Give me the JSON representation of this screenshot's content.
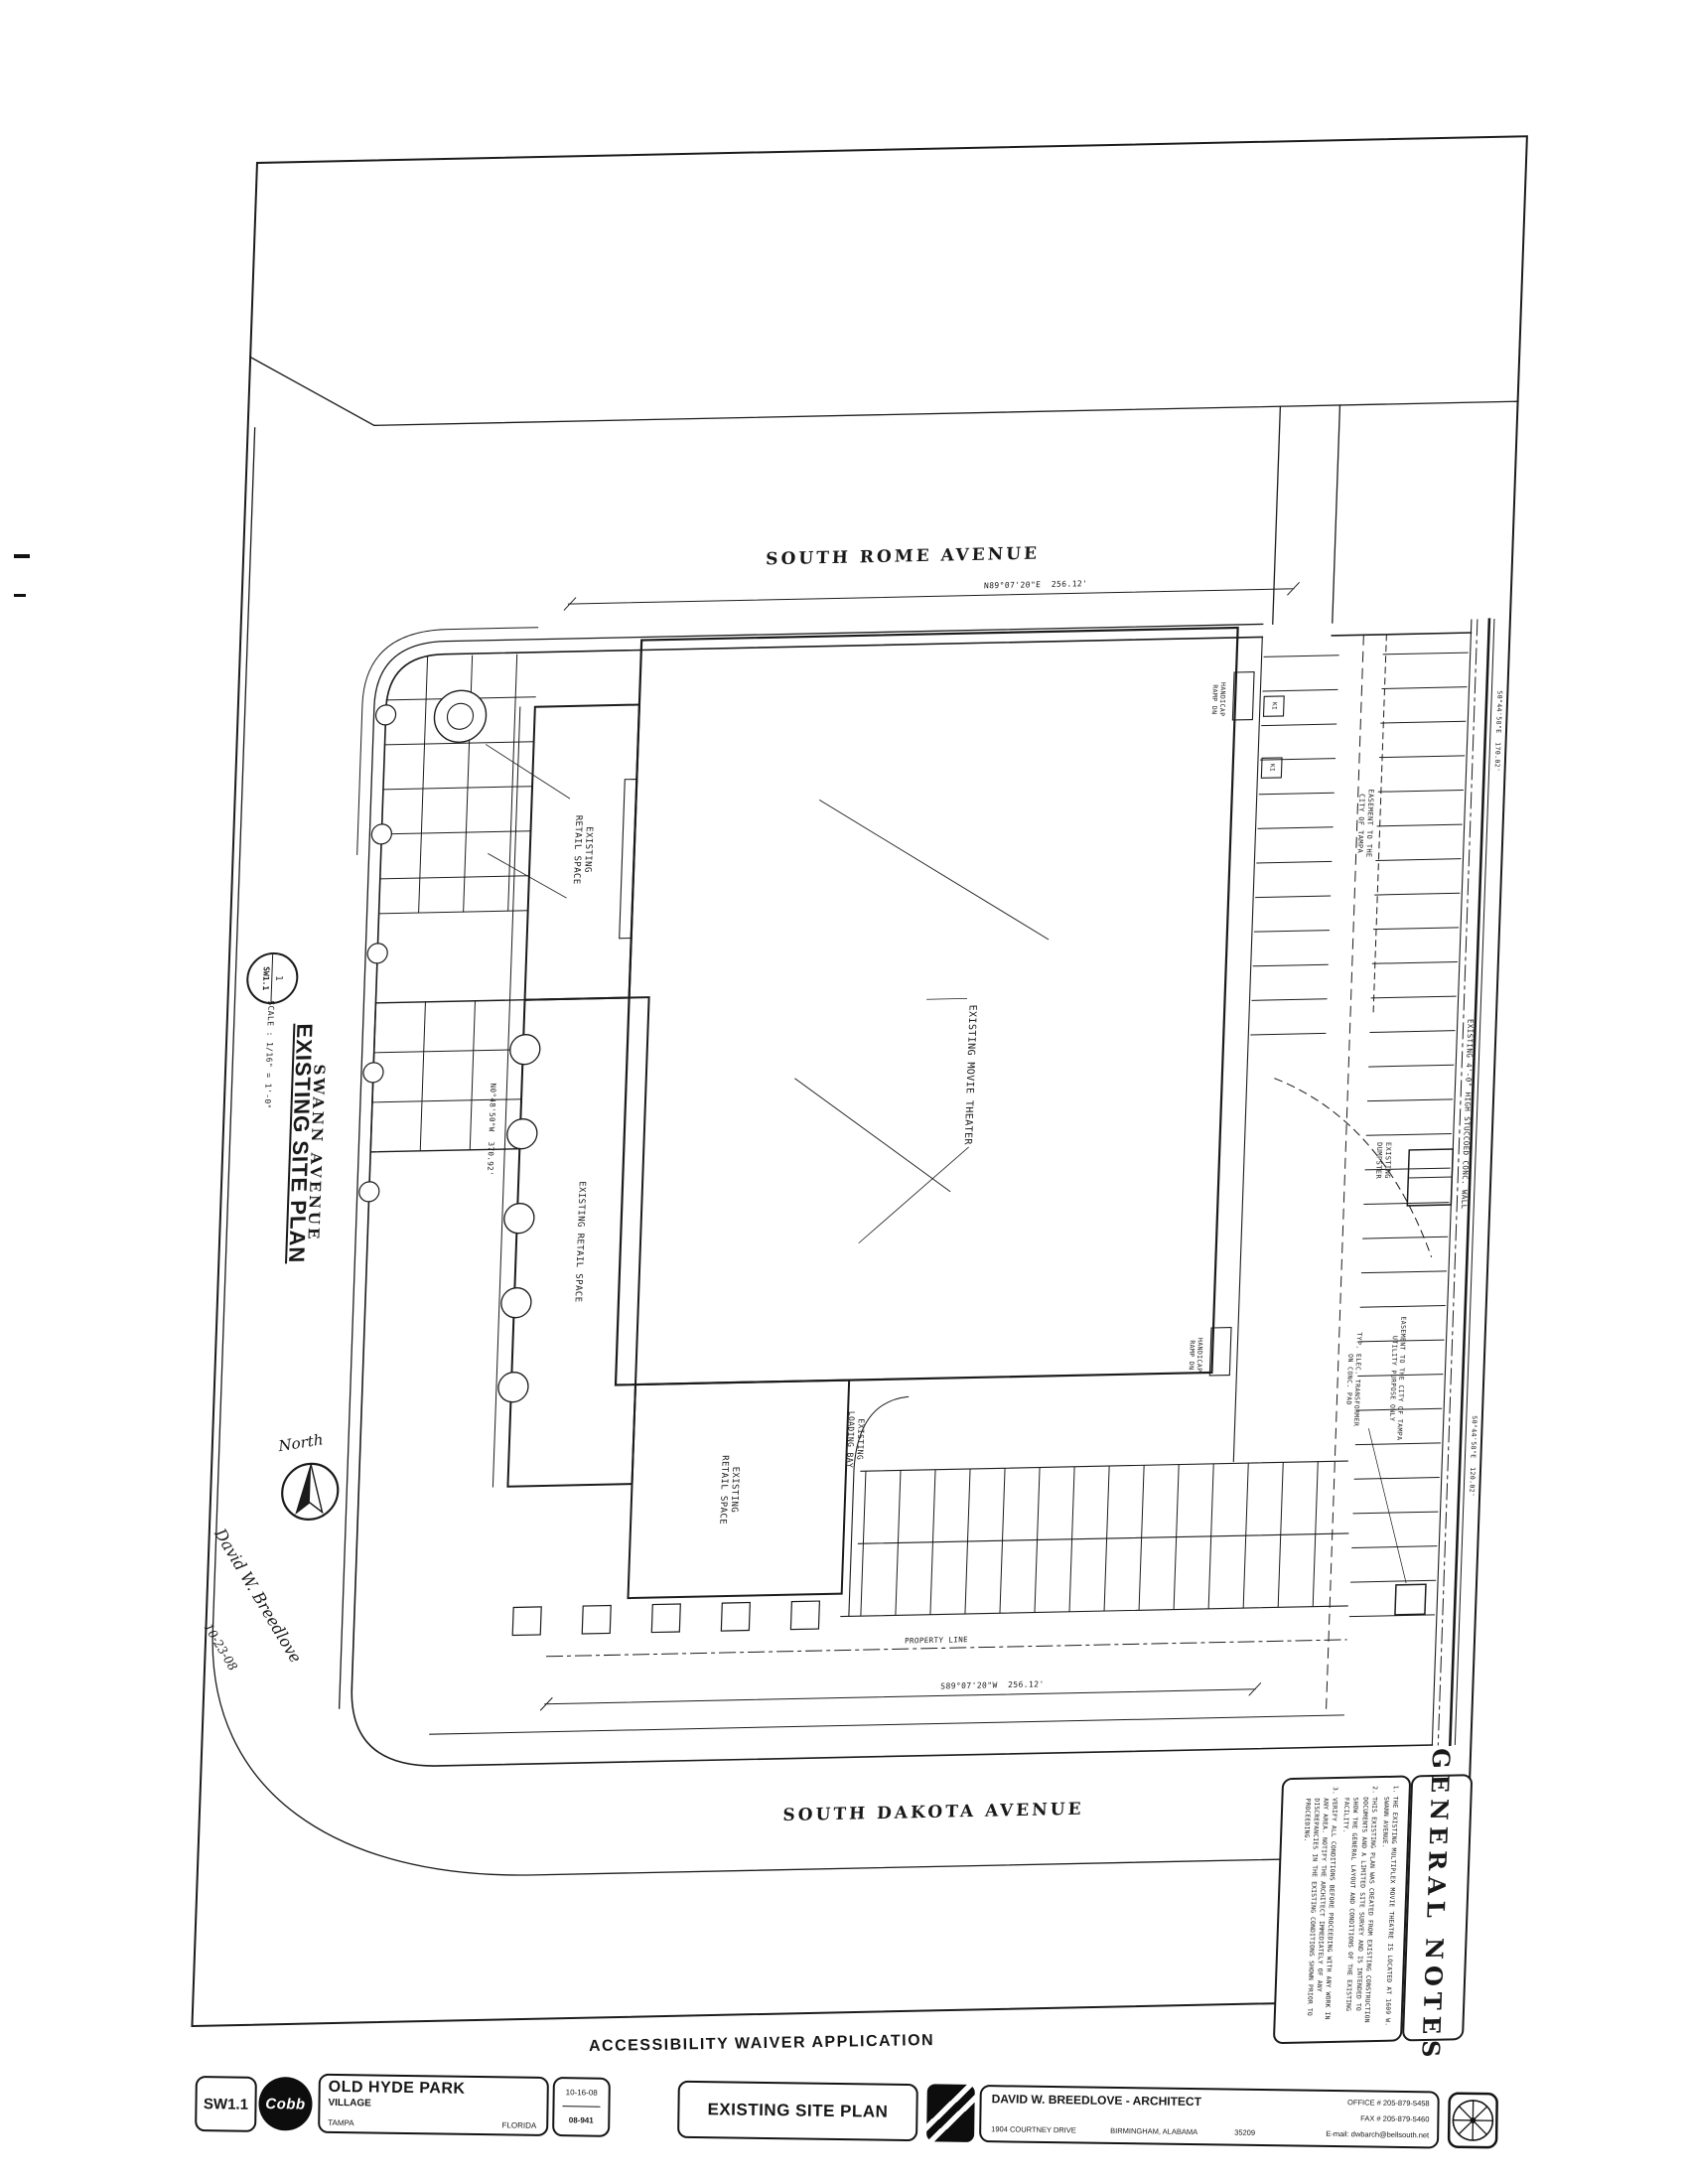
{
  "streets": {
    "north": "SOUTH ROME AVENUE",
    "south": "SOUTH DAKOTA AVENUE",
    "west": "SWANN AVENUE"
  },
  "callout": {
    "detail_number": "1",
    "sheet_ref": "SW1.1",
    "title": "EXISTING SITE PLAN",
    "scale": "SCALE : 1/16\" = 1'-0\""
  },
  "plan_labels": {
    "theater": "EXISTING MOVIE THEATER",
    "retail_upper": "EXISTING\nRETAIL SPACE",
    "retail_mid": "EXISTING RETAIL SPACE",
    "retail_south": "EXISTING\nRETAIL SPACE",
    "loading_bay": "EXISTING\nLOADING BAY",
    "handicap_ramp": "HANDICAP\nRAMP DN",
    "easement_top": "EASEMENT TO THE\nCITY OF TAMPA",
    "easement_utility": "EASEMENT TO THE CITY OF TAMPA\nUTILITY PURPOSE ONLY",
    "dumpster": "EXISTING\nDUMPSTER",
    "transformer": "TYP. ELEC. TRANSFORMER\nON CONC. PAD",
    "conc_wall": "EXISTING 4'-0\" HIGH STUCCOED CONC. WALL",
    "property_line": "PROPERTY LINE",
    "kiosk": "KI"
  },
  "bearings": {
    "top": "N89°07'20\"E  256.12'",
    "bottom": "S89°07'20\"W  256.12'",
    "left": "N0°48'50\"W  370.92'",
    "right_top": "S0°44'58\"E  170.02'",
    "right_bottom": "S0°44'58\"E  120.02'"
  },
  "handwritten": {
    "north": "North",
    "signature": "David W. Breedlove",
    "date": "10-23-08"
  },
  "general_notes": {
    "title": "GENERAL NOTES",
    "notes": [
      {
        "num": "1.",
        "text": "THE EXISTING MULTIPLEX MOVIE THEATRE IS LOCATED AT 1609 W. SWANN AVENUE."
      },
      {
        "num": "2.",
        "text": "THIS EXISTING PLAN WAS CREATED FROM EXISTING CONSTRUCTION DOCUMENTS AND A LIMITED SITE SURVEY AND IS INTENDED TO SHOW THE GENERAL LAYOUT AND CONDITIONS OF THE EXISTING FACILITY."
      },
      {
        "num": "3.",
        "text": "VERIFY ALL CONDITIONS BEFORE PROCEEDING WITH ANY WORK IN ANY AREA. NOTIFY THE ARCHITECT IMMEDIATELY OF ANY DISCREPANCIES IN THE EXISTING CONDITIONS SHOWN PRIOR TO PROCEEDING."
      }
    ]
  },
  "subtitle": "ACCESSIBILITY WAIVER APPLICATION",
  "titleblock": {
    "sheet_no": "SW1.1",
    "logo": "Cobb",
    "project_line1": "OLD HYDE PARK",
    "project_line2": "VILLAGE",
    "city": "TAMPA",
    "state": "FLORIDA",
    "date": "10-16-08",
    "job_no": "08-941",
    "sheet_title": "EXISTING SITE PLAN",
    "firm": "DAVID W. BREEDLOVE - ARCHITECT",
    "address": "1904 COURTNEY DRIVE",
    "address_city": "BIRMINGHAM, ALABAMA",
    "zip": "35209",
    "office": "OFFICE # 205-879-5458",
    "fax": "FAX # 205-879-5460",
    "email": "E-mail: dwbarch@bellsouth.net"
  }
}
